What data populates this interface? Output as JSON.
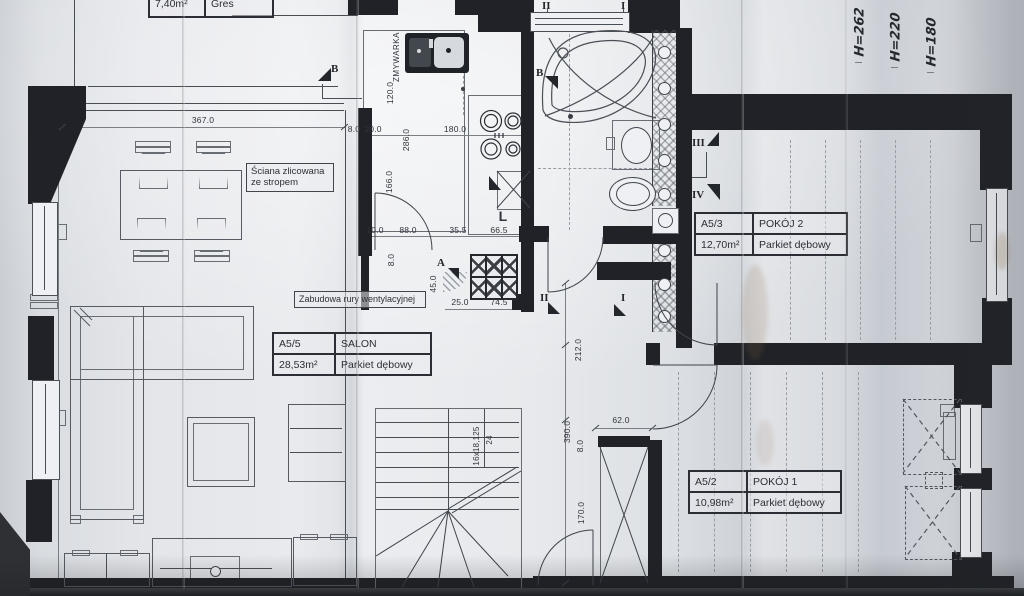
{
  "colors": {
    "paper": "#dfe2e6",
    "ink": "#3f444b",
    "wall": "#202227",
    "crease_shadow": "#c3c8cf"
  },
  "kitchen_table": {
    "area": "7,40m²",
    "floor": "Gres"
  },
  "salon_table": {
    "id": "A5/5",
    "name": "SALON",
    "area": "28,53m²",
    "floor": "Parkiet dębowy"
  },
  "room2_table": {
    "id": "A5/3",
    "name": "POKÓJ 2",
    "area": "12,70m²",
    "floor": "Parkiet dębowy"
  },
  "room1_table": {
    "id": "A5/2",
    "name": "POKÓJ 1",
    "area": "10,98m²",
    "floor": "Parkiet dębowy"
  },
  "notes": {
    "wall_note": "Ściana zlicowana ze stropem",
    "vent_note": "Zabudowa rury wentylacyjnej",
    "dishwasher": "ZMYWARKA",
    "l_mark": "L"
  },
  "markers": {
    "a": "A",
    "b_top": "B",
    "b_bath": "B",
    "i_top": "I",
    "ii_top": "II",
    "i_hall": "I",
    "ii_hall": "II",
    "iii": "III",
    "iv": "IV",
    "iv_kitchen": "IV"
  },
  "dims": {
    "d367": "367.0",
    "d120": "120.0",
    "d286": "286.0",
    "d8a": "8.0",
    "d20": "20.0",
    "d180": "180.0",
    "d166": "166.0",
    "d10": "10.0",
    "d88": "88.0",
    "d35_5": "35.5",
    "d66_5": "66.5",
    "d8b": "8.0",
    "d45": "45.0",
    "d25": "25.0",
    "d74_5": "74.5",
    "d212": "212.0",
    "d390": "390.0",
    "d8c": "8.0",
    "d62": "62.0",
    "d170": "170.0"
  },
  "stairs": {
    "treads": "16x18,125",
    "count": "24"
  },
  "heights": [
    "H=262",
    "H=220",
    "H=180"
  ]
}
